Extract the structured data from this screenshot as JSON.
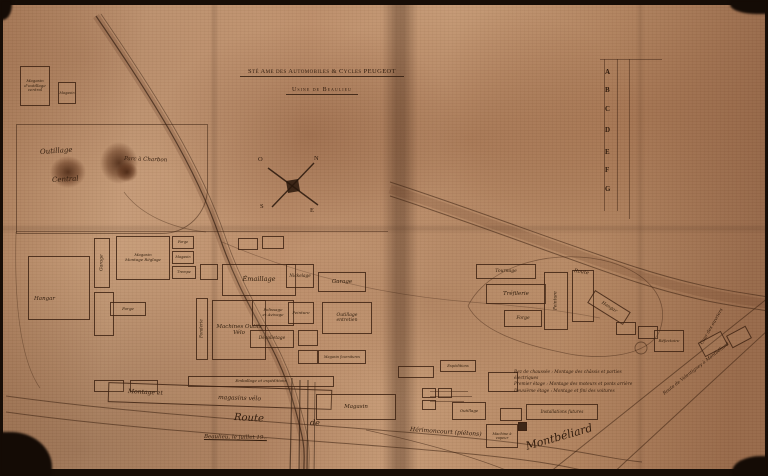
{
  "title": {
    "line1": "Sté Ame des Automobiles & Cycles PEUGEOT",
    "line2": "Usine de Beaulieu"
  },
  "legend": {
    "letters": [
      "A",
      "B",
      "C",
      "D",
      "E",
      "F",
      "G"
    ],
    "letter_ys": [
      68,
      86,
      105,
      126,
      148,
      166,
      185
    ]
  },
  "compass": {
    "n": "N",
    "s": "S",
    "e": "E",
    "o": "O"
  },
  "floors_note": {
    "lines": [
      "Rez de chaussée : Montage des châssis et parties électriques",
      "Premier étage : Montage des moteurs et ponts arrière",
      "Deuxième étage : Montage et fini des voitures"
    ]
  },
  "colors": {
    "paper": "#bb8d6a",
    "ink": "#3a2212",
    "stain": "#55250f",
    "edge": "#170d06"
  },
  "map": {
    "buildings": [
      {
        "x": 20,
        "y": 66,
        "w": 30,
        "h": 40,
        "label": "Magasin\nd'outillage\ncentral",
        "fs": 4
      },
      {
        "x": 58,
        "y": 82,
        "w": 18,
        "h": 22,
        "label": "Magasin",
        "fs": 3.5
      },
      {
        "x": 28,
        "y": 256,
        "w": 62,
        "h": 64,
        "label": "",
        "fs": 4
      },
      {
        "x": 94,
        "y": 238,
        "w": 16,
        "h": 50,
        "label": "Garage",
        "fs": 4.5,
        "vert": true
      },
      {
        "x": 116,
        "y": 236,
        "w": 54,
        "h": 44,
        "label": "Magasin\nMontage Réglage",
        "fs": 4
      },
      {
        "x": 172,
        "y": 236,
        "w": 22,
        "h": 13,
        "label": "Forge",
        "fs": 3.5
      },
      {
        "x": 172,
        "y": 251,
        "w": 22,
        "h": 13,
        "label": "Magasin",
        "fs": 3.5
      },
      {
        "x": 172,
        "y": 266,
        "w": 24,
        "h": 13,
        "label": "Trempe",
        "fs": 3.5
      },
      {
        "x": 94,
        "y": 292,
        "w": 20,
        "h": 44,
        "label": "",
        "fs": 4
      },
      {
        "x": 110,
        "y": 302,
        "w": 36,
        "h": 14,
        "label": "Forge",
        "fs": 4
      },
      {
        "x": 238,
        "y": 238,
        "w": 20,
        "h": 12,
        "label": "",
        "fs": 4
      },
      {
        "x": 262,
        "y": 236,
        "w": 22,
        "h": 13,
        "label": "",
        "fs": 4
      },
      {
        "x": 200,
        "y": 264,
        "w": 18,
        "h": 16,
        "label": "",
        "fs": 4
      },
      {
        "x": 222,
        "y": 264,
        "w": 74,
        "h": 32,
        "label": "Émaillage",
        "fs": 6.5
      },
      {
        "x": 286,
        "y": 264,
        "w": 28,
        "h": 24,
        "label": "Nickelage",
        "fs": 4.2
      },
      {
        "x": 318,
        "y": 272,
        "w": 48,
        "h": 20,
        "label": "Garage",
        "fs": 5.5
      },
      {
        "x": 196,
        "y": 298,
        "w": 12,
        "h": 62,
        "label": "Fonderie",
        "fs": 4.2,
        "vert": true
      },
      {
        "x": 212,
        "y": 300,
        "w": 54,
        "h": 60,
        "label": "Machines Outils\nVélo",
        "fs": 5.5
      },
      {
        "x": 252,
        "y": 300,
        "w": 42,
        "h": 26,
        "label": "Polissage\net Avivage",
        "fs": 4
      },
      {
        "x": 288,
        "y": 302,
        "w": 26,
        "h": 22,
        "label": "Peinture",
        "fs": 4
      },
      {
        "x": 250,
        "y": 330,
        "w": 44,
        "h": 18,
        "label": "Décolletage",
        "fs": 4.4
      },
      {
        "x": 322,
        "y": 302,
        "w": 50,
        "h": 32,
        "label": "Outillage\nentretien",
        "fs": 4.5
      },
      {
        "x": 298,
        "y": 330,
        "w": 20,
        "h": 16,
        "label": "",
        "fs": 4
      },
      {
        "x": 298,
        "y": 350,
        "w": 20,
        "h": 14,
        "label": "",
        "fs": 4
      },
      {
        "x": 318,
        "y": 350,
        "w": 48,
        "h": 14,
        "label": "Magasin fournitures",
        "fs": 3.5
      },
      {
        "x": 94,
        "y": 380,
        "w": 30,
        "h": 12,
        "label": "",
        "fs": 4
      },
      {
        "x": 130,
        "y": 380,
        "w": 28,
        "h": 12,
        "label": "",
        "fs": 4
      },
      {
        "x": 188,
        "y": 376,
        "w": 146,
        "h": 11,
        "label": "Emballage et expéditions",
        "fs": 4
      },
      {
        "x": 108,
        "y": 386,
        "w": 224,
        "h": 20,
        "label": "",
        "fs": 4,
        "rot": 2
      },
      {
        "x": 316,
        "y": 394,
        "w": 80,
        "h": 26,
        "label": "Magasin",
        "fs": 5.5
      },
      {
        "x": 452,
        "y": 402,
        "w": 34,
        "h": 18,
        "label": "Outillage",
        "fs": 4
      },
      {
        "x": 486,
        "y": 424,
        "w": 32,
        "h": 24,
        "label": "Machine à\nvapeur",
        "fs": 3.6
      },
      {
        "x": 518,
        "y": 422,
        "w": 9,
        "h": 9,
        "label": "",
        "fill": true
      },
      {
        "x": 500,
        "y": 408,
        "w": 22,
        "h": 13,
        "label": "",
        "fs": 4
      },
      {
        "x": 526,
        "y": 404,
        "w": 72,
        "h": 16,
        "label": "Installations futures",
        "fs": 4.2
      },
      {
        "x": 476,
        "y": 264,
        "w": 60,
        "h": 15,
        "label": "Tournage",
        "fs": 4.5
      },
      {
        "x": 486,
        "y": 284,
        "w": 60,
        "h": 20,
        "label": "Tréfilerie",
        "fs": 5.5
      },
      {
        "x": 504,
        "y": 310,
        "w": 38,
        "h": 17,
        "label": "Forge",
        "fs": 4.5
      },
      {
        "x": 544,
        "y": 272,
        "w": 24,
        "h": 58,
        "label": "Peinture",
        "fs": 4.4,
        "vert": true
      },
      {
        "x": 572,
        "y": 270,
        "w": 22,
        "h": 52,
        "label": "",
        "fs": 4
      },
      {
        "x": 588,
        "y": 300,
        "w": 42,
        "h": 15,
        "label": "Hangar",
        "fs": 4.5,
        "rot": 32
      },
      {
        "x": 616,
        "y": 322,
        "w": 20,
        "h": 13,
        "label": "",
        "fs": 4
      },
      {
        "x": 638,
        "y": 326,
        "w": 20,
        "h": 13,
        "label": "",
        "fs": 4
      },
      {
        "x": 654,
        "y": 330,
        "w": 30,
        "h": 22,
        "label": "Réfectoire",
        "fs": 4
      },
      {
        "x": 700,
        "y": 336,
        "w": 26,
        "h": 16,
        "label": "",
        "fs": 4,
        "rot": -28
      },
      {
        "x": 728,
        "y": 330,
        "w": 22,
        "h": 14,
        "label": "",
        "fs": 4,
        "rot": -28
      },
      {
        "x": 398,
        "y": 366,
        "w": 36,
        "h": 12,
        "label": "",
        "fs": 4
      },
      {
        "x": 440,
        "y": 360,
        "w": 36,
        "h": 12,
        "label": "Expéditions",
        "fs": 3.6
      },
      {
        "x": 488,
        "y": 372,
        "w": 30,
        "h": 20,
        "label": "",
        "fs": 4
      },
      {
        "x": 422,
        "y": 388,
        "w": 14,
        "h": 10,
        "label": "",
        "fs": 4
      },
      {
        "x": 422,
        "y": 400,
        "w": 14,
        "h": 10,
        "label": "",
        "fs": 4
      },
      {
        "x": 438,
        "y": 388,
        "w": 14,
        "h": 10,
        "label": "",
        "fs": 4
      }
    ],
    "labels": [
      {
        "x": 40,
        "y": 148,
        "text": "Outillage",
        "fs": 7,
        "rot": -4
      },
      {
        "x": 52,
        "y": 176,
        "text": "Central",
        "fs": 7,
        "rot": -3
      },
      {
        "x": 124,
        "y": 156,
        "text": "Parc à Charbon",
        "fs": 5.5,
        "rot": 2
      },
      {
        "x": 34,
        "y": 296,
        "text": "Hangar",
        "fs": 5.5,
        "rot": 0
      },
      {
        "x": 128,
        "y": 388,
        "text": "Montage et",
        "fs": 6,
        "rot": 3
      },
      {
        "x": 218,
        "y": 394,
        "text": "magasins vélo",
        "fs": 6,
        "rot": 2
      },
      {
        "x": 234,
        "y": 412,
        "text": "Route",
        "fs": 10,
        "rot": 3
      },
      {
        "x": 310,
        "y": 418,
        "text": "de",
        "fs": 8,
        "rot": 3
      },
      {
        "x": 410,
        "y": 426,
        "text": "Hérimoncourt (piétons)",
        "fs": 6,
        "rot": 4
      },
      {
        "x": 526,
        "y": 440,
        "text": "Montbéliard",
        "fs": 11,
        "rot": -16
      },
      {
        "x": 664,
        "y": 392,
        "text": "Route de Valentigney à Montbéliard",
        "fs": 4.5,
        "rot": -38
      },
      {
        "x": 702,
        "y": 342,
        "text": "Cour des ouvriers",
        "fs": 4.5,
        "rot": -60
      },
      {
        "x": 574,
        "y": 268,
        "text": "Route",
        "fs": 5,
        "rot": 9
      },
      {
        "x": 204,
        "y": 434,
        "text": "Beaulieu, le    juillet 19..",
        "fs": 5.5,
        "rot": 1,
        "u": true
      }
    ],
    "lines": [
      {
        "x": 600,
        "y": 59,
        "w": 62,
        "h": 1
      },
      {
        "x": 604,
        "y": 59,
        "w": 1,
        "h": 152
      },
      {
        "x": 617,
        "y": 59,
        "w": 1,
        "h": 152
      },
      {
        "x": 629,
        "y": 59,
        "w": 1,
        "h": 160
      },
      {
        "x": 16,
        "y": 231,
        "w": 372,
        "h": 1
      },
      {
        "x": 430,
        "y": 391,
        "w": 38,
        "h": 1
      },
      {
        "x": 430,
        "y": 396,
        "w": 42,
        "h": 1
      },
      {
        "x": 430,
        "y": 401,
        "w": 34,
        "h": 1
      }
    ],
    "stains": [
      {
        "x": 50,
        "y": 156,
        "w": 36,
        "h": 32
      },
      {
        "x": 100,
        "y": 142,
        "w": 38,
        "h": 42
      },
      {
        "x": 116,
        "y": 162,
        "w": 22,
        "h": 20
      }
    ],
    "outlines": [
      {
        "x": 16,
        "y": 124,
        "w": 190,
        "h": 108,
        "radius": "0 0 46px 0"
      }
    ]
  }
}
